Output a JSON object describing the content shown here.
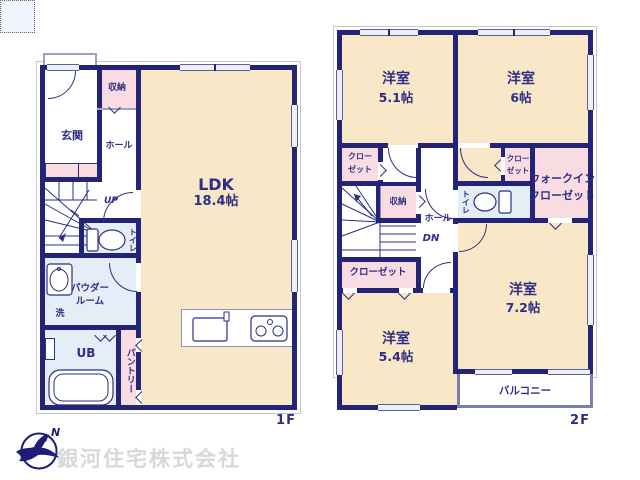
{
  "floor1": {
    "label": "1F",
    "genkan": "玄関",
    "storage": "収納",
    "hall": "ホール",
    "ldk_name": "LDK",
    "ldk_size": "18.4帖",
    "up": "UP",
    "toilet": "トイレ",
    "powder_line1": "パウダー",
    "powder_line2": "ルーム",
    "laundry": "洗",
    "bath": "UB",
    "pantry": "パントリー"
  },
  "floor2": {
    "label": "2F",
    "room_5_1_name": "洋室",
    "room_5_1_size": "5.1帖",
    "room_6_name": "洋室",
    "room_6_size": "6帖",
    "closet_nw_line1": "クロー",
    "closet_nw_line2": "ゼット",
    "storage": "収納",
    "hall": "ホール",
    "dn": "DN",
    "toilet": "トイレ",
    "closet_small_line1": "クロー",
    "closet_small_line2": "ゼット",
    "wic_line1": "ウォークイン",
    "wic_line2": "クローゼット",
    "closet_south": "クローゼット",
    "room_7_2_name": "洋室",
    "room_7_2_size": "7.2帖",
    "room_5_4_name": "洋室",
    "room_5_4_size": "5.4帖",
    "balcony": "バルコニー"
  },
  "footer": {
    "company": "銀河住宅株式会社",
    "north": "N"
  },
  "palette": {
    "wall": "#232377",
    "text": "#2e2e85",
    "room_cream": "#f9e8c7",
    "closet_pink": "#f9dce2",
    "wet_blue": "#e4eef6",
    "window": "#eef0f8",
    "company_gray": "#d8d8da"
  }
}
